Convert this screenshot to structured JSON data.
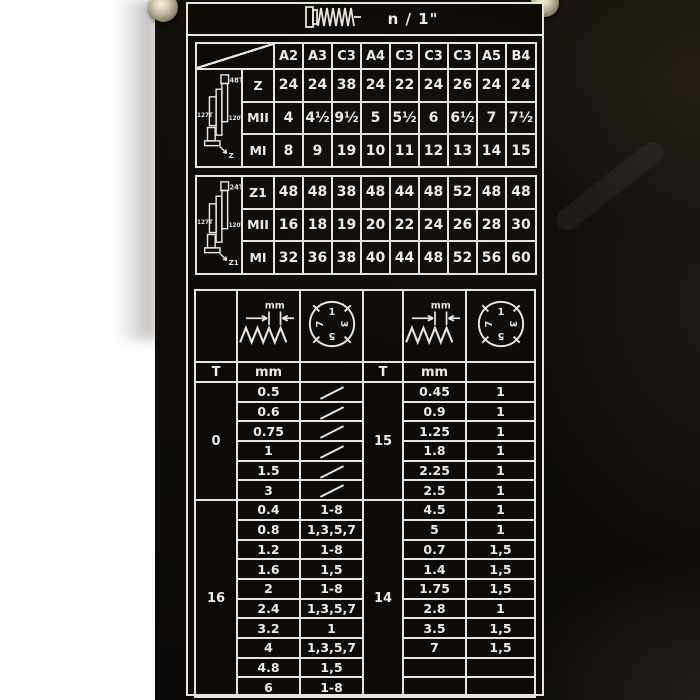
{
  "photo": {
    "background_color": "#fdfdfd",
    "machine_color": "#0d0a08",
    "engraving_color": "#e8e4da"
  },
  "plate": {
    "title_label": "n / 1\"",
    "title_icon": "bolt-thread-icon",
    "gear_table": {
      "column_headers": [
        "A2",
        "A3",
        "C3",
        "A4",
        "C3",
        "C3",
        "C3",
        "A5",
        "B4"
      ],
      "blocks": [
        {
          "diagram": {
            "top_gear": "48T",
            "left_gear": "127T",
            "right_gear": "120T",
            "output": "Z"
          },
          "rows": [
            {
              "label": "Z",
              "values": [
                "24",
                "24",
                "38",
                "24",
                "22",
                "24",
                "26",
                "24",
                "24"
              ]
            },
            {
              "label": "MII",
              "values": [
                "4",
                "4½",
                "9½",
                "5",
                "5½",
                "6",
                "6½",
                "7",
                "7½"
              ]
            },
            {
              "label": "MI",
              "values": [
                "8",
                "9",
                "19",
                "10",
                "11",
                "12",
                "13",
                "14",
                "15"
              ]
            }
          ]
        },
        {
          "diagram": {
            "top_gear": "24T",
            "left_gear": "127T",
            "right_gear": "120T",
            "output": "Z1"
          },
          "rows": [
            {
              "label": "Z1",
              "values": [
                "48",
                "48",
                "38",
                "48",
                "44",
                "48",
                "52",
                "48",
                "48"
              ]
            },
            {
              "label": "MII",
              "values": [
                "16",
                "18",
                "19",
                "20",
                "22",
                "24",
                "26",
                "28",
                "30"
              ]
            },
            {
              "label": "MI",
              "values": [
                "32",
                "36",
                "38",
                "40",
                "44",
                "48",
                "52",
                "56",
                "60"
              ]
            }
          ]
        }
      ]
    },
    "thread_table": {
      "t_header": "T",
      "mm_header": "mm",
      "dial_numbers": [
        "1",
        "3",
        "5",
        "7"
      ],
      "left_groups": [
        {
          "t": "0",
          "rows": [
            [
              "0.5",
              "/"
            ],
            [
              "0.6",
              "/"
            ],
            [
              "0.75",
              "/"
            ],
            [
              "1",
              "/"
            ],
            [
              "1.5",
              "/"
            ],
            [
              "3",
              "/"
            ]
          ]
        },
        {
          "t": "16",
          "rows": [
            [
              "0.4",
              "1-8"
            ],
            [
              "0.8",
              "1,3,5,7"
            ],
            [
              "1.2",
              "1-8"
            ],
            [
              "1.6",
              "1,5"
            ],
            [
              "2",
              "1-8"
            ],
            [
              "2.4",
              "1,3,5,7"
            ],
            [
              "3.2",
              "1"
            ],
            [
              "4",
              "1,3,5,7"
            ],
            [
              "4.8",
              "1,5"
            ],
            [
              "6",
              "1-8"
            ]
          ]
        }
      ],
      "right_groups": [
        {
          "t": "15",
          "rows": [
            [
              "0.45",
              "1"
            ],
            [
              "0.9",
              "1"
            ],
            [
              "1.25",
              "1"
            ],
            [
              "1.8",
              "1"
            ],
            [
              "2.25",
              "1"
            ],
            [
              "2.5",
              "1"
            ]
          ]
        },
        {
          "t": "14",
          "rows": [
            [
              "4.5",
              "1"
            ],
            [
              "5",
              "1"
            ],
            [
              "0.7",
              "1,5"
            ],
            [
              "1.4",
              "1,5"
            ],
            [
              "1.75",
              "1,5"
            ],
            [
              "2.8",
              "1"
            ],
            [
              "3.5",
              "1,5"
            ],
            [
              "7",
              "1,5"
            ],
            [
              "",
              ""
            ],
            [
              "",
              ""
            ]
          ]
        }
      ]
    }
  }
}
